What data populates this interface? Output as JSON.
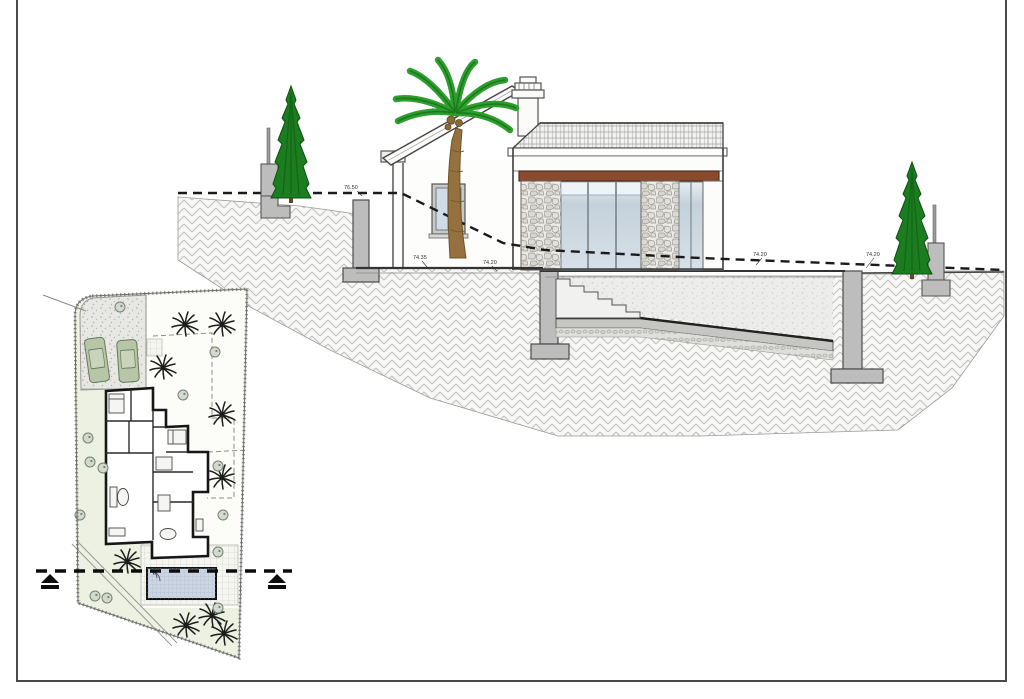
{
  "levels": [
    {
      "value": "76.50"
    },
    {
      "value": "74.35"
    },
    {
      "value": "74.20"
    },
    {
      "value": "74.20"
    },
    {
      "value": "74.20"
    }
  ],
  "colors": {
    "beam": "#8a4a2e",
    "palm_frond": "#2d9e2d",
    "palm_frond_dark": "#1c7a1c",
    "palm_trunk": "#967140",
    "cypress": "#1b7d1f",
    "car": "#b7c6a6",
    "pool_plan": "#ccd5e3",
    "glass": "#cfdbe6",
    "concrete": "#bdbdbd",
    "lawn": "#edf1e2",
    "ink": "#3c3c3c"
  }
}
